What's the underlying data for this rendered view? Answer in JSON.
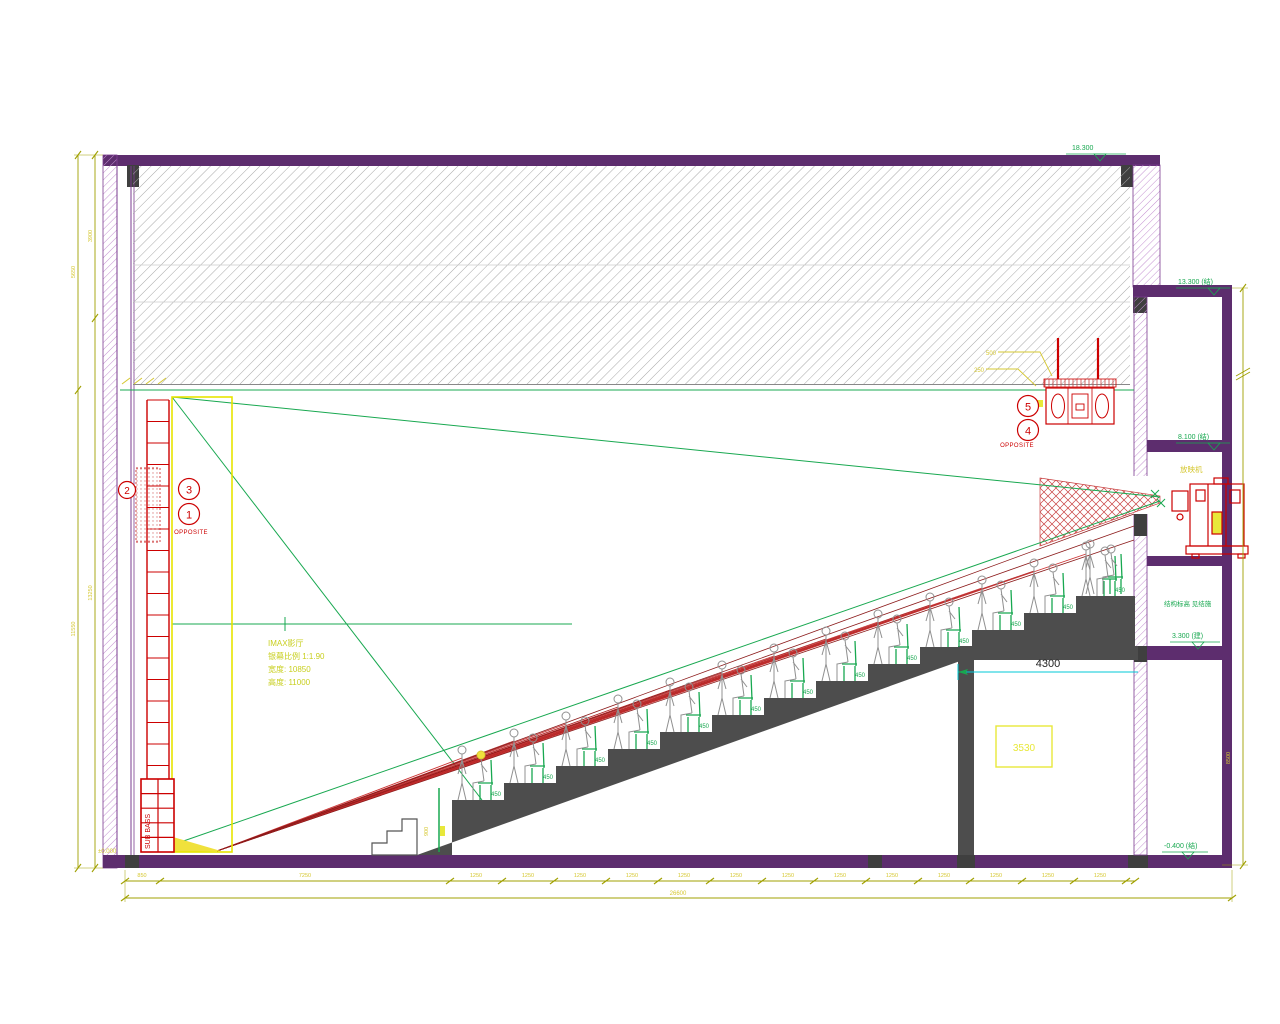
{
  "drawing": {
    "callouts": {
      "c1": "1",
      "c2": "2",
      "c3": "3",
      "c4": "4",
      "c5": "5",
      "opposite_left": "OPPOSITE",
      "opposite_right": "OPPOSITE"
    },
    "screen_note": {
      "line1": "IMAX影厅",
      "line2": "银幕比例 1:1.90",
      "line3": "宽度: 10850",
      "line4": "高度: 11000"
    },
    "labels": {
      "sub_bass": "SUB BASS",
      "projector": "放映机",
      "booth_note": "结构标高 见结施",
      "room_number": "3530",
      "under_seat_dim": "4300",
      "datum": "±0.000",
      "rail_height": "900",
      "speaker_dim_1": "500",
      "speaker_dim_2": "250",
      "seat_dim": "450"
    },
    "elevations": {
      "roof": "18.300",
      "level3": "13.300 (结)",
      "level2": "8.100 (结)",
      "level1": "3.300 (建)",
      "ground": "-0.400 (结)"
    },
    "dimensions": {
      "bottom_row1": [
        "850",
        "7250",
        "1250",
        "1250",
        "1250",
        "1250",
        "1250",
        "1250",
        "1250",
        "1250",
        "1250",
        "1250",
        "1250",
        "1250",
        "1250"
      ],
      "bottom_total": "26600",
      "left_outer": [
        "5650",
        "11550"
      ],
      "left_inner": [
        "3900",
        "13250"
      ],
      "right_vertical": "8500"
    },
    "seating": {
      "row_count": 13
    },
    "colors": {
      "wall_purple": "#5d2d6e",
      "hatch_gray": "#a8a8a8",
      "line_green": "#18a850",
      "line_red": "#cc0000",
      "dark_red": "#8b1a1a",
      "dim_olive": "#a0a000",
      "text_yellow": "#d6c832",
      "screen_yellow": "#e8e400",
      "cyan": "#00c8d7",
      "step_gray": "#4d4d4d"
    }
  }
}
